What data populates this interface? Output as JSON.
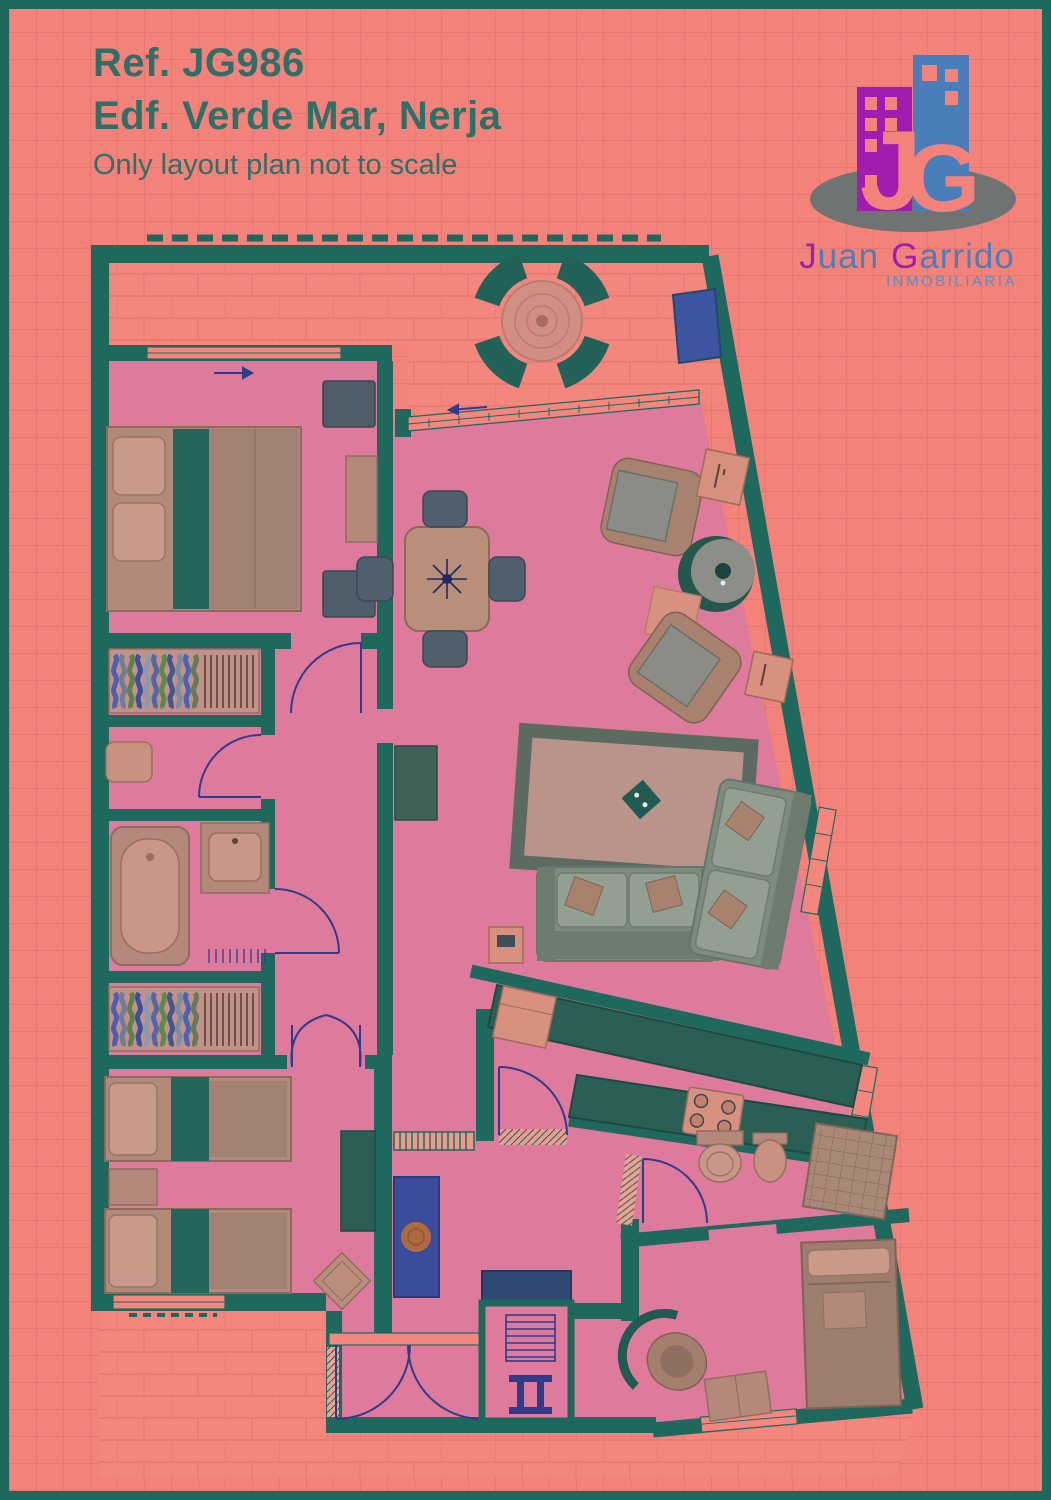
{
  "header": {
    "reference": "Ref. JG986",
    "building": "Edf. Verde Mar, Nerja",
    "disclaimer": "Only layout plan not to scale"
  },
  "logo": {
    "monogram_j": "J",
    "monogram_g": "G",
    "name_j": "J",
    "name_uan": "uan",
    "name_g": "G",
    "name_arrido": "arrido",
    "subtitle": "INMOBILIARIA"
  },
  "colors": {
    "page_bg": "#F2827A",
    "frame": "#1F685E",
    "wall": "#1F685E",
    "floor_pink": "#DE7A9B",
    "terrace": "#F3877E",
    "title_text": "#2E6F68",
    "logo_blue": "#4D7EB8",
    "logo_magenta": "#A21CAF",
    "door_arc": "#2F3C8C",
    "furniture_tan": "#B4897B",
    "sofa_green": "#7E8C80"
  }
}
